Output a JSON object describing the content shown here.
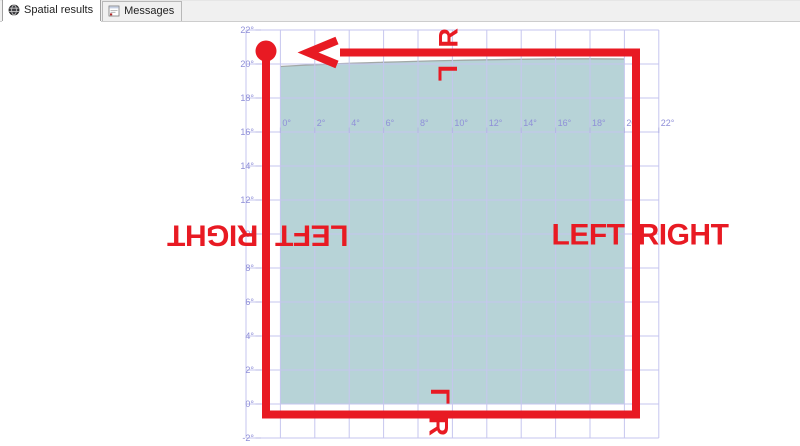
{
  "window": {
    "tabs": [
      {
        "label": "Spatial results",
        "icon": "globe-icon",
        "active": true
      },
      {
        "label": "Messages",
        "icon": "messages-icon",
        "active": false
      }
    ]
  },
  "colors": {
    "route_red": "#e81a23",
    "polygon_fill": "#b7d3d7",
    "polygon_top_edge": "#a2a8a6",
    "gridline": "#c6c6ef",
    "tick": "#b5b5e5",
    "axis_text": "#8f8fd8",
    "tabstrip_bg": "#f0f0f0",
    "page_bg": "#ffffff"
  },
  "chart_data": {
    "type": "spatial-map",
    "title": "",
    "x_axis": {
      "tick_labels": [
        "0°",
        "2°",
        "4°",
        "6°",
        "8°",
        "10°",
        "12°",
        "14°",
        "16°",
        "18°",
        "20°",
        "22°"
      ],
      "range_deg": [
        -2,
        22
      ],
      "grid": true
    },
    "y_axis": {
      "tick_labels": [
        "22°",
        "20°",
        "18°",
        "16°",
        "14°",
        "12°",
        "10°",
        "8°",
        "6°",
        "4°",
        "2°",
        "0°",
        "-2°"
      ],
      "range_deg": [
        -2,
        22
      ],
      "grid": true
    },
    "polygon": {
      "description": "teal filled square region with slightly curved top edge",
      "extent_deg": {
        "x": [
          0,
          20
        ],
        "y": [
          0,
          20
        ]
      }
    },
    "route": {
      "description": "red rectangular path drawn counter-clockwise around polygon",
      "start_marker": "circle-top-left",
      "end_marker": "arrow-pointing-left-along-top",
      "extent_deg": {
        "x": [
          -0.8,
          20.7
        ],
        "y": [
          -0.6,
          20.6
        ]
      }
    },
    "annotations": [
      {
        "text": "R",
        "x": 448,
        "y": 38,
        "rot": -90,
        "size": 27,
        "mirror": false,
        "side": "top-outside"
      },
      {
        "text": "L",
        "x": 448,
        "y": 73,
        "rot": 90,
        "size": 27,
        "mirror": false,
        "side": "top-inside"
      },
      {
        "text": "RIGHT",
        "x": 213,
        "y": 236,
        "rot": 180,
        "size": 30,
        "mirror": false,
        "side": "left-outside"
      },
      {
        "text": "LEFT",
        "x": 312,
        "y": 236,
        "rot": 180,
        "size": 30,
        "mirror": false,
        "side": "left-inside"
      },
      {
        "text": "LEFT",
        "x": 588,
        "y": 234,
        "rot": 0,
        "size": 30,
        "mirror": false,
        "side": "right-inside"
      },
      {
        "text": "RIGHT",
        "x": 683,
        "y": 234,
        "rot": 0,
        "size": 30,
        "mirror": false,
        "side": "right-outside"
      },
      {
        "text": "L",
        "x": 440,
        "y": 396,
        "rot": -90,
        "size": 27,
        "mirror": true,
        "side": "bottom-inside"
      },
      {
        "text": "R",
        "x": 439,
        "y": 426,
        "rot": 90,
        "size": 27,
        "mirror": false,
        "side": "bottom-outside"
      }
    ],
    "layout_px": {
      "grid": {
        "left": 246,
        "top": 30,
        "dx": 34.4,
        "dy": 34,
        "cols": 13,
        "rows": 13
      },
      "y_labels": {
        "x": 254,
        "tick_x1": 255.5,
        "tick_x2": 261
      },
      "x_labels": {
        "baseline_y": 126,
        "offset_x": 2,
        "tick_y1": 127.5,
        "tick_y2": 133
      },
      "polygon_fill_path": "M280.4,404 L280.4,66.5 C370,61.5 530,58 624.4,59 L624.4,404 Z",
      "polygon_top_edge_path": "M280.4,66.5 C370,61.5 530,58 624.4,59",
      "route_points": "266,57 266,414.5 636,414.5 636,52.5 340,52.5",
      "route_width": 8,
      "arrow_points": "337,40.5 308,52.5 337,64.5",
      "start_circle": {
        "cx": 266,
        "cy": 51,
        "r": 10.5
      }
    }
  }
}
